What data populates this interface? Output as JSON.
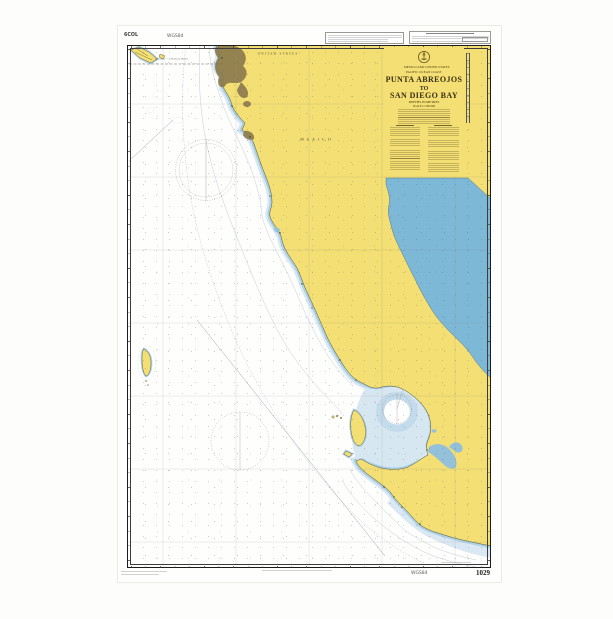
{
  "chart": {
    "number": "1029",
    "datum_top": "WGS84",
    "datum_bottom": "WGS84",
    "corner_code": "6COL",
    "title_block": {
      "emblem_icon": "admiralty-crest",
      "nations": "MEXICO AND UNITED STATES",
      "region": "PACIFIC OCEAN COAST",
      "title1": "PUNTA ABREOJOS",
      "title2": "TO",
      "title3": "SAN DIEGO BAY",
      "depths": "DEPTHS IN METRES",
      "scale": "SCALE 1:1 000 000"
    },
    "geo_labels": {
      "united_states": "UNITED STATES",
      "mexico": "M E X I C O",
      "boundary": "MEXICO — UNITED STATES"
    },
    "colors": {
      "land": "#f3df73",
      "shallow_water": "#abcfe3",
      "shallow_tint": "#d9e8f2",
      "bay_tint": "#c3dbea",
      "gulf_water": "#7db8d6",
      "deep_sea": "#ffffff",
      "urban": "#8d7c4f"
    }
  }
}
